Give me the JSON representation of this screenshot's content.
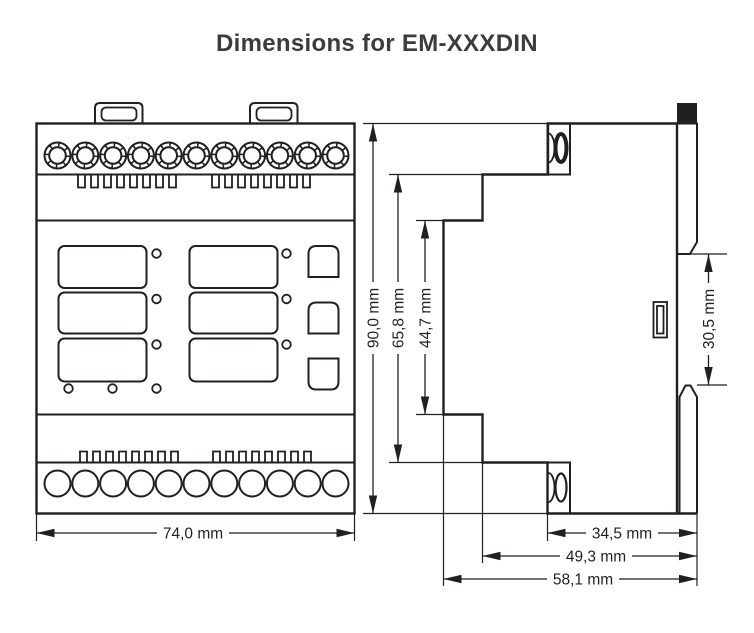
{
  "title": "Dimensions for EM-XXXDIN",
  "dimensions": {
    "front_width": "74,0 mm",
    "total_height": "90,0 mm",
    "step_height": "65,8 mm",
    "panel_height": "44,7 mm",
    "din_clip_span": "30,5 mm",
    "depth_to_terminal": "34,5 mm",
    "depth_to_step": "49,3 mm",
    "depth_total": "58,1 mm"
  },
  "colors": {
    "line": "#231f20",
    "title_text": "#3c3c3c",
    "background": "#ffffff"
  }
}
